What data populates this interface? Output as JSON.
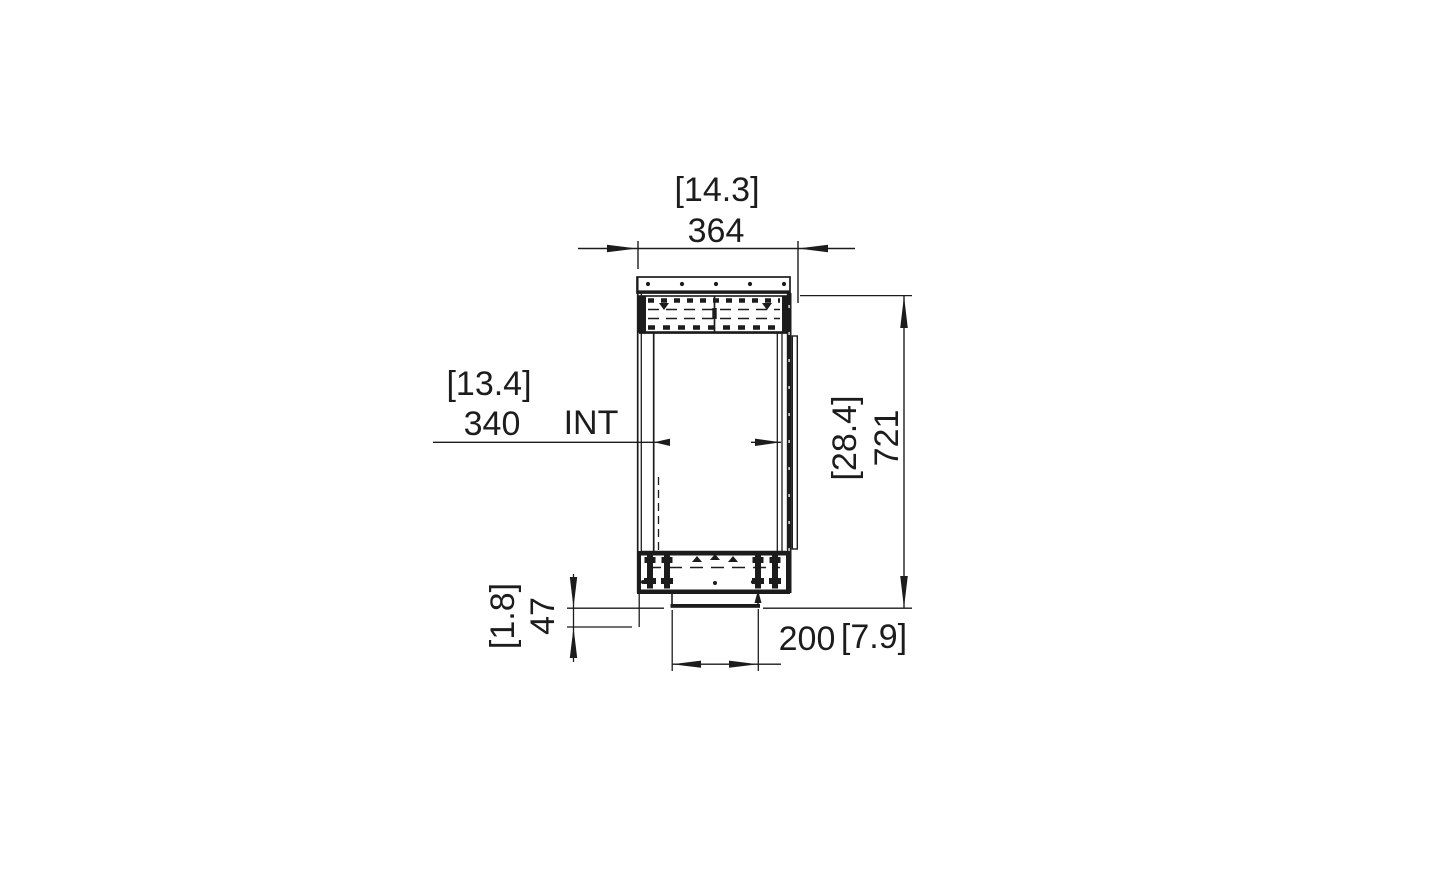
{
  "meta": {
    "background_color": "#ffffff",
    "line_color": "#1c1c1c",
    "drawing_kind": "technical side elevation with dimensions"
  },
  "dimensions": {
    "top_width": {
      "imperial": "[14.3]",
      "metric": "364"
    },
    "interior_width": {
      "imperial": "[13.4]",
      "metric": "340",
      "suffix": "INT"
    },
    "overall_height": {
      "imperial": "[28.4]",
      "metric": "721"
    },
    "base_offset": {
      "imperial": "[1.8]",
      "metric": "47"
    },
    "outlet_width": {
      "metric": "200",
      "imperial": "[7.9]"
    }
  }
}
